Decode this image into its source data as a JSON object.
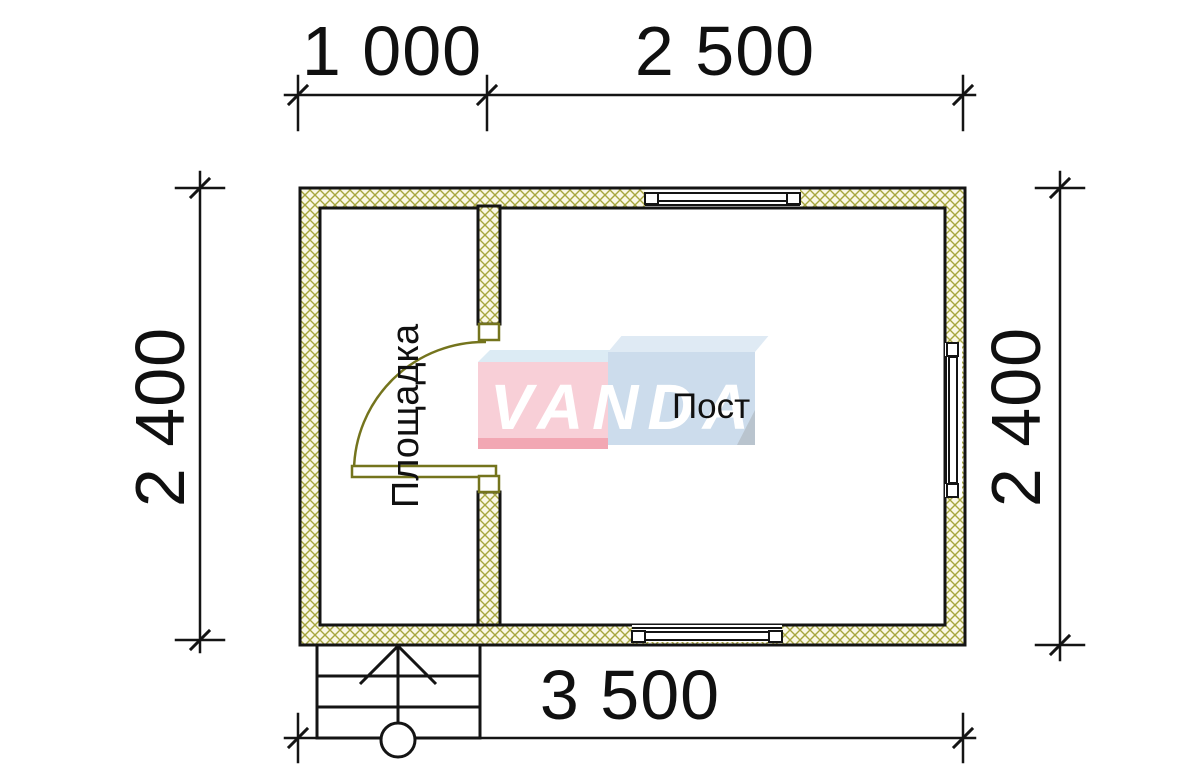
{
  "dimensions": {
    "top": [
      "1 000",
      "2 500"
    ],
    "left": "2 400",
    "right": "2 400",
    "bottom": "3 500"
  },
  "rooms": {
    "vestibule": "Площадка",
    "main": "Пост"
  },
  "logo": {
    "text": "VANDA"
  },
  "colors": {
    "line": "#141414",
    "hatch_line": "#a7a63f",
    "hatch_bg": "#fbf8e6",
    "door": "#74741d",
    "logo_pink": "#f8cfd7",
    "logo_pink_dark": "#f2a7b3",
    "logo_blue": "#ccdcec",
    "logo_blue_light": "#dfeaf4"
  }
}
